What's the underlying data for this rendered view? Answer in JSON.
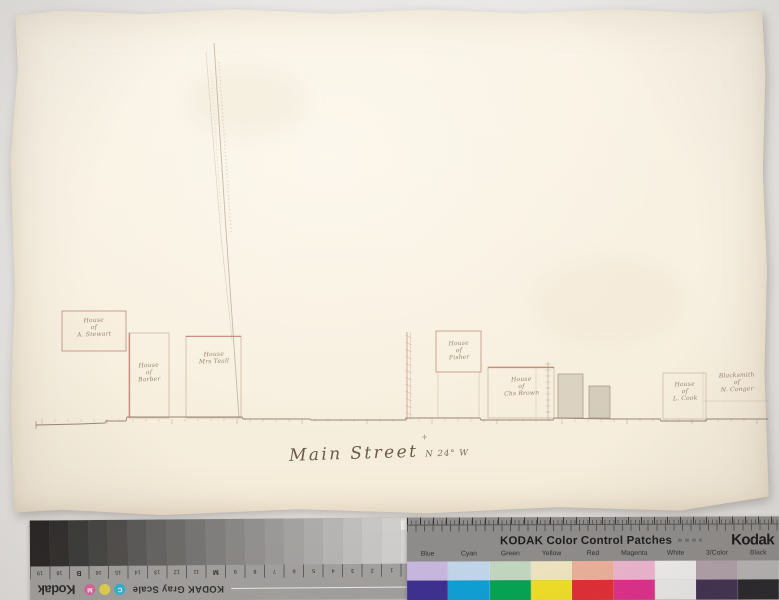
{
  "photo": {
    "background_color": "#e8e6e3",
    "paper_color": "#f8f1e3",
    "ink_color": "#8a7263",
    "accent_ink_color": "#c0766a"
  },
  "map": {
    "street_label": "Main Street",
    "street_bearing": "N 24° W",
    "buildings": [
      {
        "lines": [
          "House",
          "of",
          "A. Stewart"
        ]
      },
      {
        "lines": [
          "House",
          "of",
          "Barber"
        ]
      },
      {
        "lines": [
          "House",
          "Mrs Teall"
        ]
      },
      {
        "lines": [
          "House",
          "of",
          "Fisher"
        ]
      },
      {
        "lines": [
          "House",
          "of",
          "Chs Brown"
        ]
      },
      {
        "lines": [
          "House",
          "of",
          "L. Cook"
        ]
      },
      {
        "lines": [
          "Blacksmith",
          "of",
          "N. Conger"
        ]
      }
    ]
  },
  "calibration": {
    "gray_scale": {
      "title": "KODAK Gray Scale",
      "brand": "Kodak",
      "steps": [
        "#d8d6d4",
        "#d0cecc",
        "#c8c6c4",
        "#c0bebc",
        "#b7b5b3",
        "#aeacaa",
        "#a5a3a1",
        "#9c9a98",
        "#939190",
        "#8a8886",
        "#817f7d",
        "#777573",
        "#6d6b69",
        "#636361",
        "#585856",
        "#4d4b49",
        "#424240",
        "#373735",
        "#2c2a28",
        "#221f1e"
      ],
      "ticks": [
        "A",
        "1",
        "2",
        "3",
        "4",
        "5",
        "6",
        "7",
        "8",
        "9",
        "M",
        "11",
        "12",
        "13",
        "14",
        "15",
        "16",
        "B",
        "18",
        "19"
      ],
      "dots": [
        {
          "letter": "C",
          "color": "#2ab5d6"
        },
        {
          "letter": "",
          "color": "#e6d34c"
        },
        {
          "letter": "M",
          "color": "#df5f9a"
        }
      ]
    },
    "color_patches": {
      "title": "KODAK Color Control Patches",
      "brand": "Kodak",
      "columns": [
        {
          "label": "Blue",
          "tint": "#c9b9e2",
          "solid": "#3b2d90"
        },
        {
          "label": "Cyan",
          "tint": "#c3d9ee",
          "solid": "#0ba0d8"
        },
        {
          "label": "Green",
          "tint": "#c5dac3",
          "solid": "#00a552"
        },
        {
          "label": "Yellow",
          "tint": "#f3e9c2",
          "solid": "#f5e224"
        },
        {
          "label": "Red",
          "tint": "#efb29b",
          "solid": "#e42a33"
        },
        {
          "label": "Magenta",
          "tint": "#f2b7d3",
          "solid": "#e22a8b"
        },
        {
          "label": "White",
          "tint": "#f4f2f1",
          "solid": "#efeeed"
        },
        {
          "label": "3/Color",
          "tint": "#b3a2ab",
          "solid": "#3b2b4e"
        },
        {
          "label": "Black",
          "tint": "#b9b7b6",
          "solid": "#211f24"
        }
      ]
    }
  }
}
